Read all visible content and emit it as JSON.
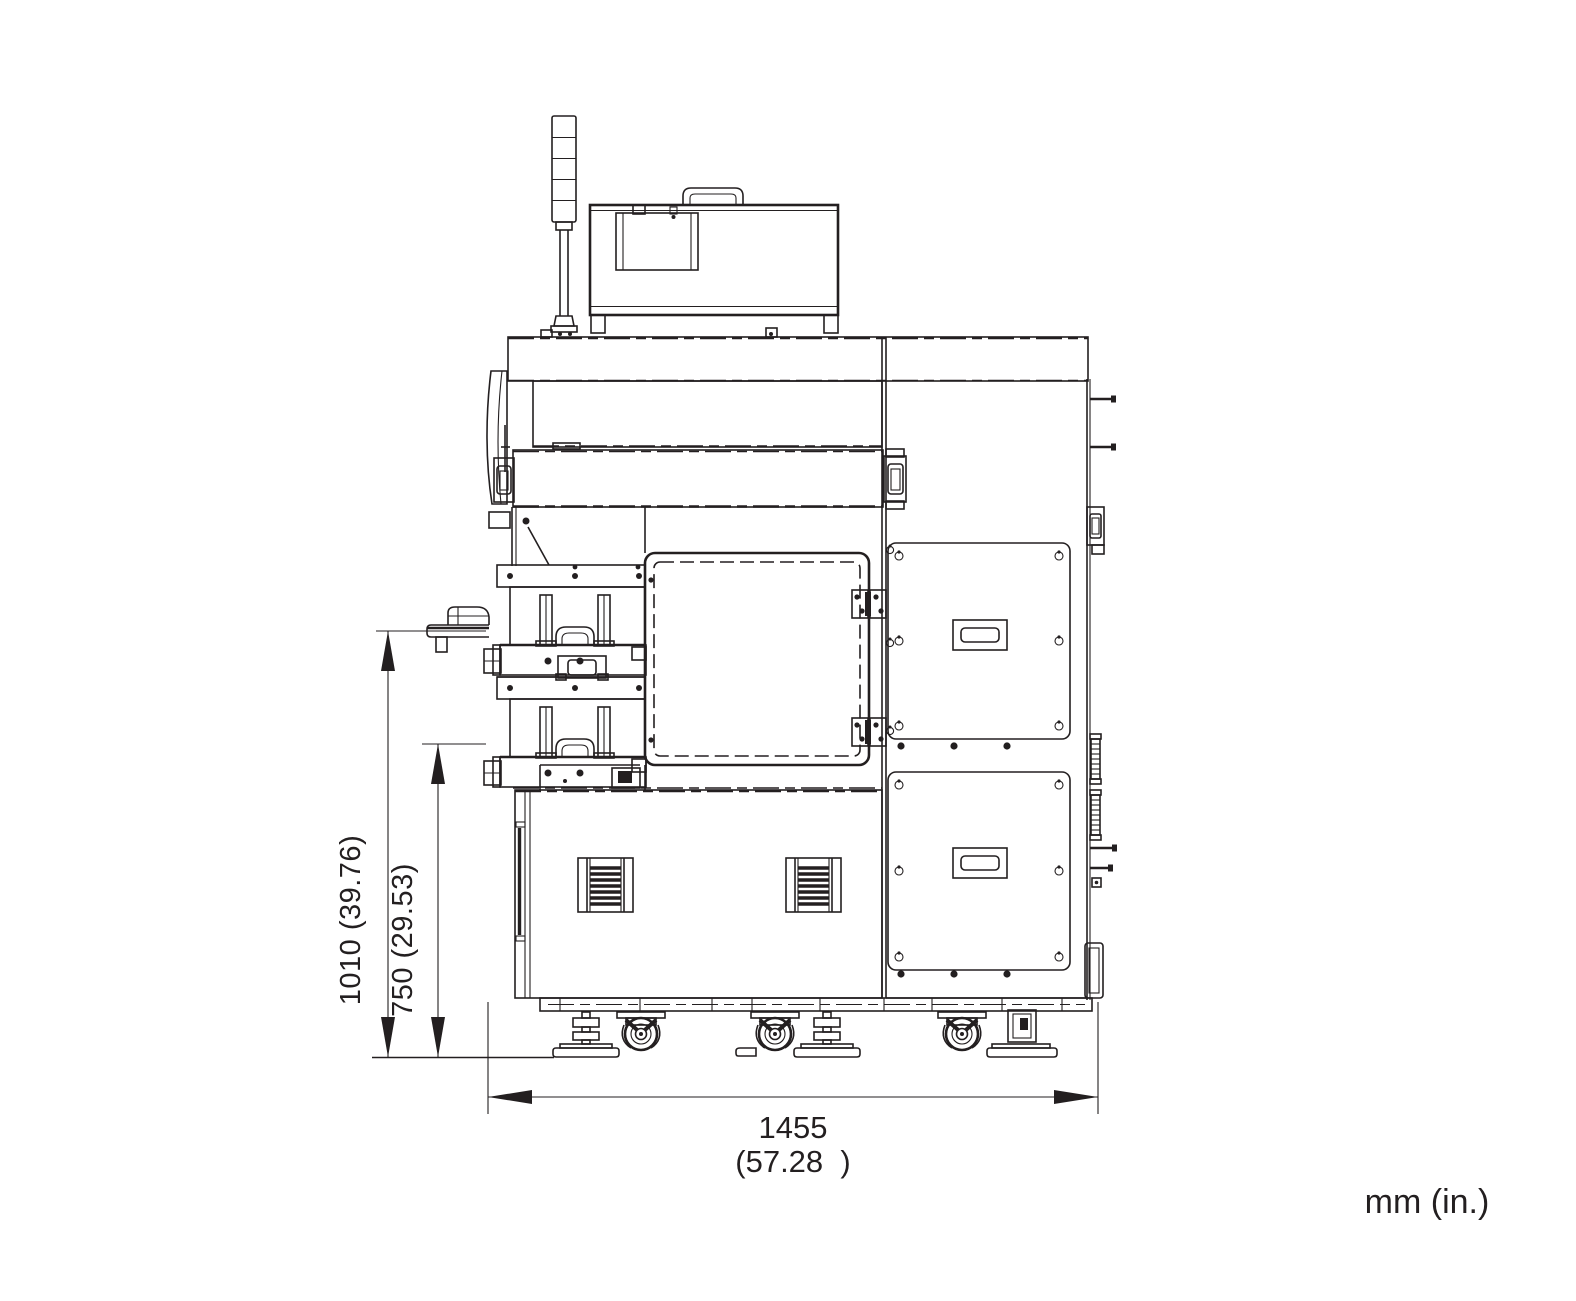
{
  "drawing": {
    "type": "machine-front-elevation-dimension-drawing",
    "units_note": "mm (in.)",
    "dimensions": {
      "overall_height_label": "1010 (39.76)",
      "table_height_label": "750 (29.53)",
      "width_mm_label": "1455",
      "width_in_label": "(57.28  )"
    },
    "colors": {
      "line": "#231f20",
      "background": "#ffffff"
    }
  }
}
